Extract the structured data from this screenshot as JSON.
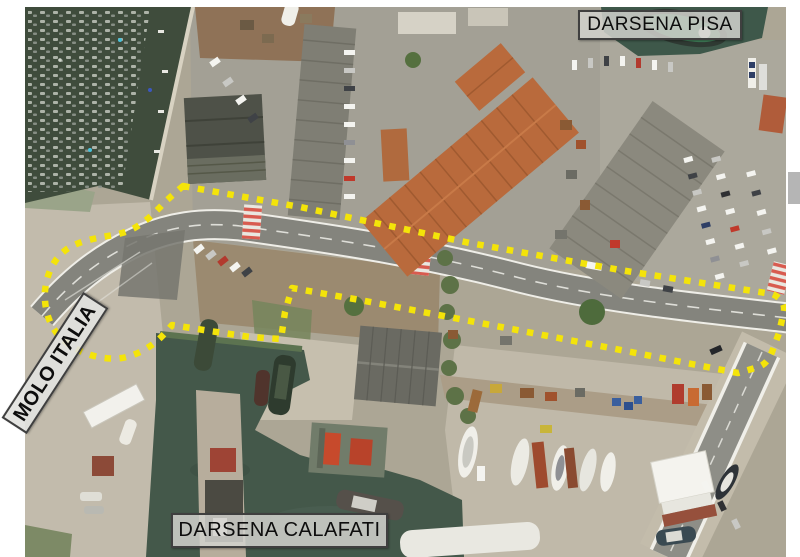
{
  "labels": {
    "pisa": "DARSENA PISA",
    "molo": "MOLO ITALIA",
    "calafati": "DARSENA CALAFATI"
  },
  "annotation": {
    "style": "dotted-outline",
    "color": "#f4e409",
    "description": "yellow dotted boundary around quay loop and road corridor"
  },
  "map_colors": {
    "water_dark": "#3f4c3c",
    "water_basin": "#44584a",
    "concrete": "#b2ab9c",
    "asphalt": "#84847d",
    "dirt": "#9b8a70",
    "orange_roof": "#b96a3c",
    "crosswalk_red": "#d85b4f"
  }
}
